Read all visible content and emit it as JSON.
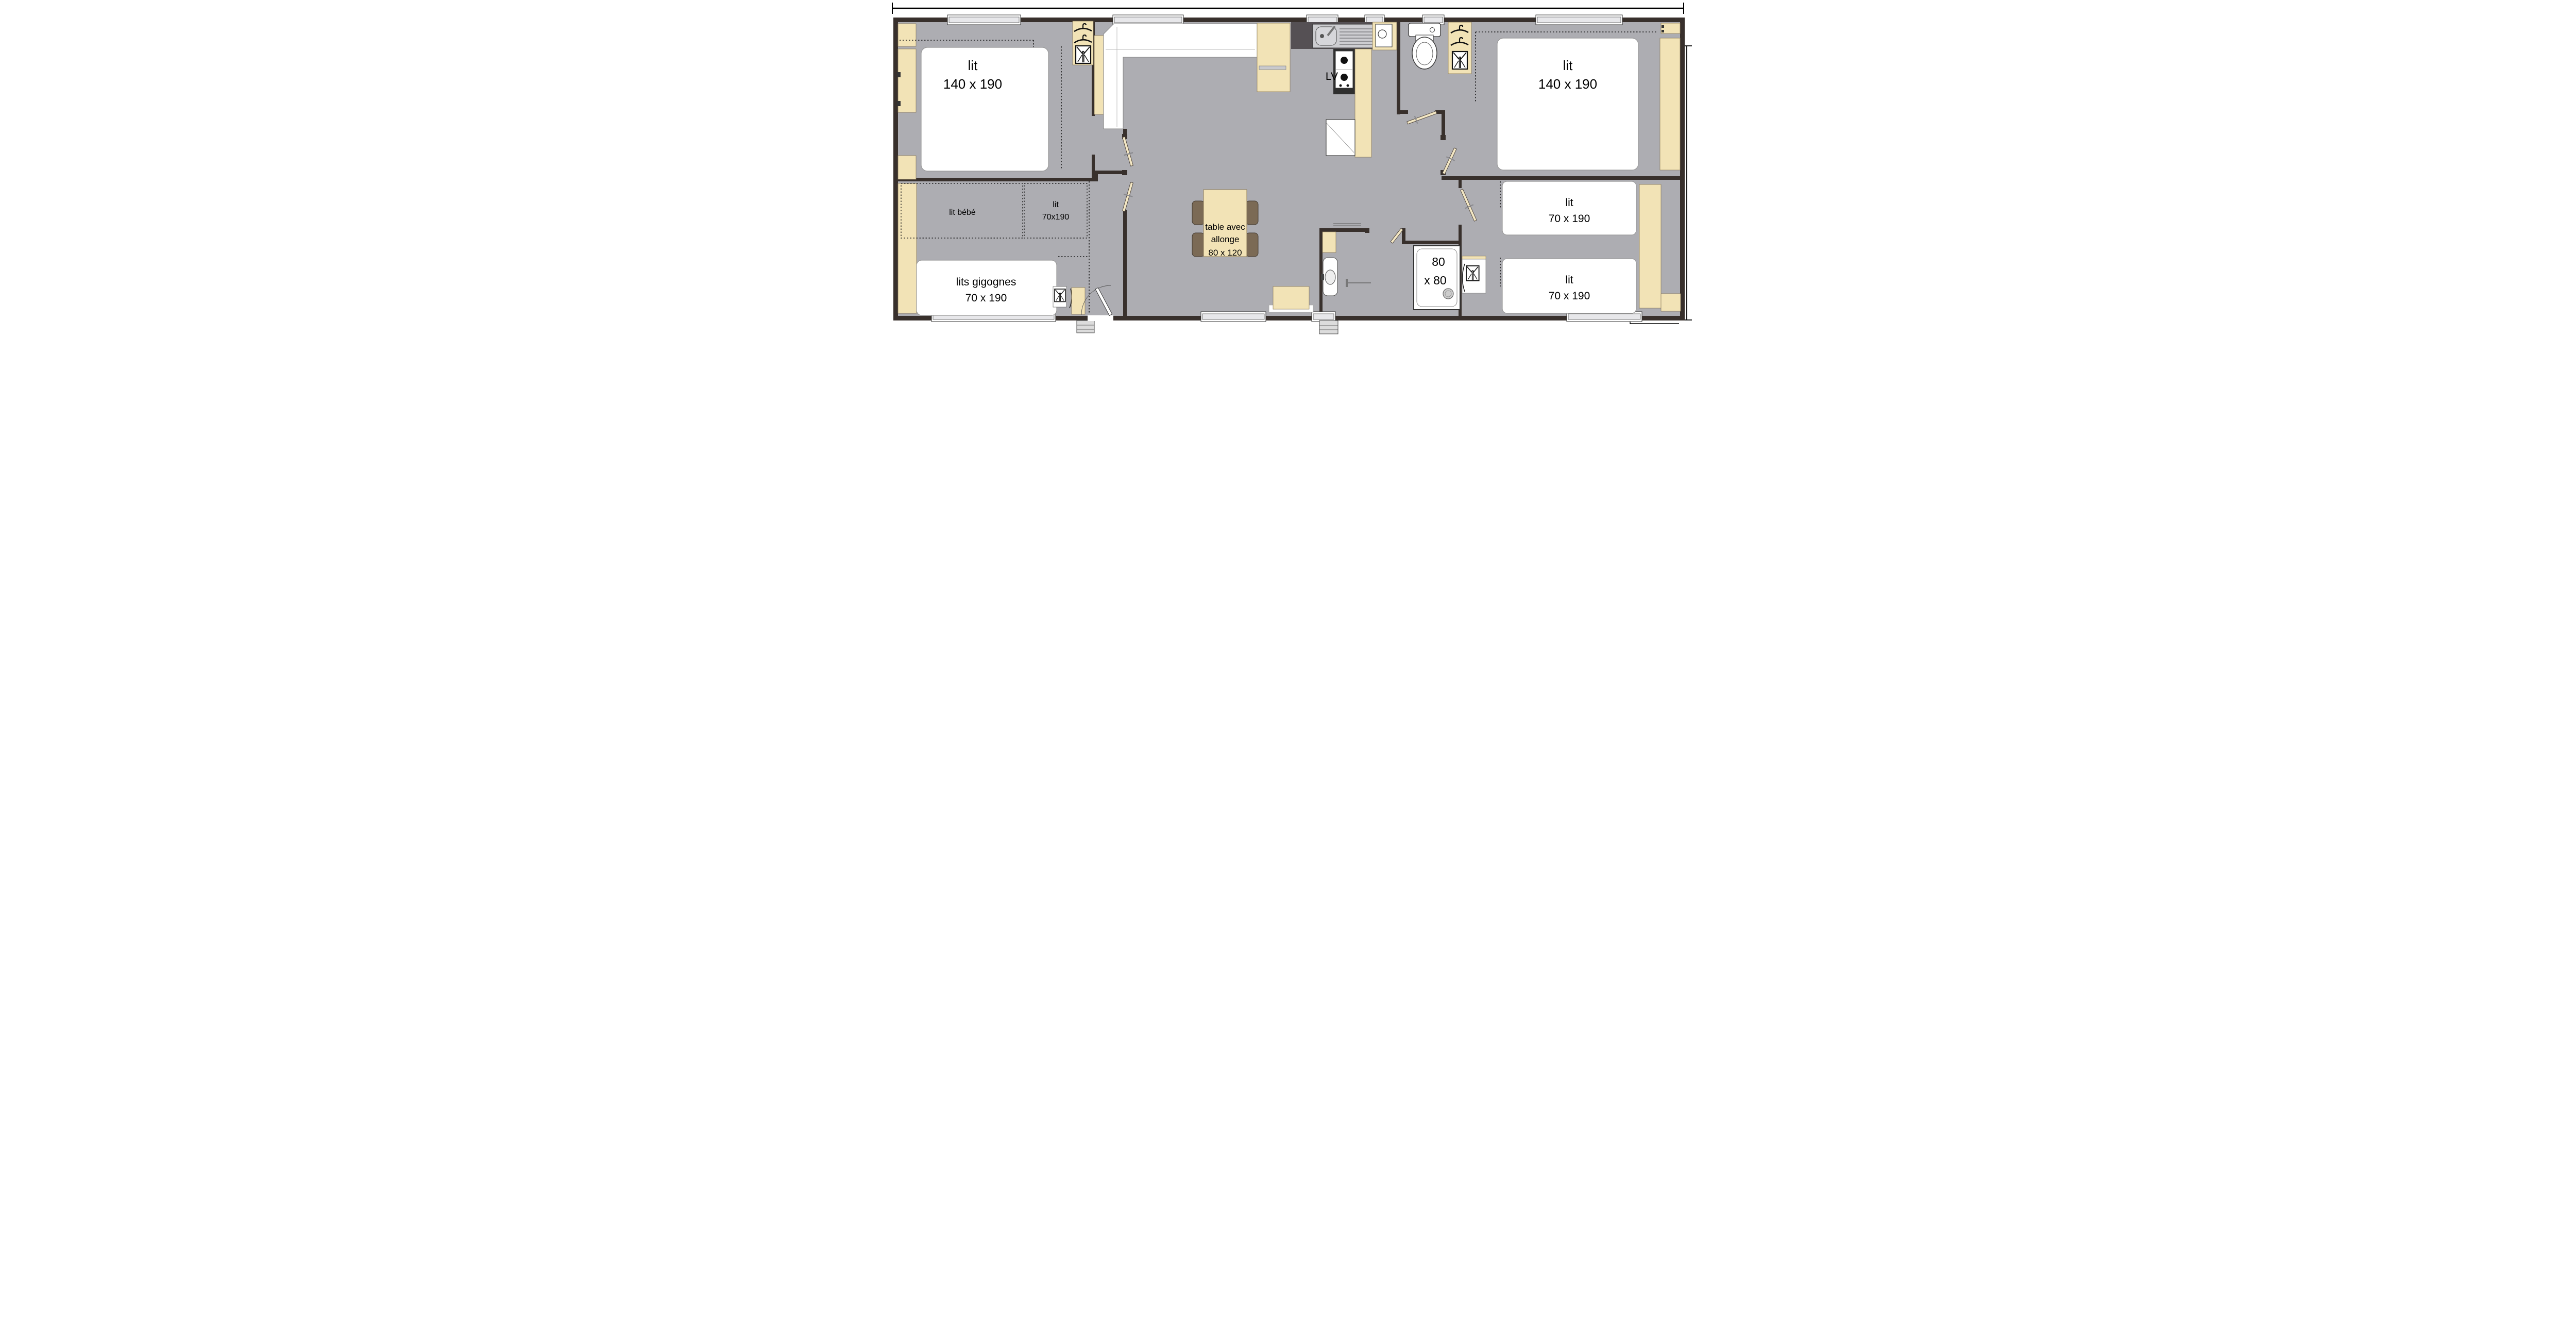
{
  "plan": {
    "type": "floor-plan",
    "labels": {
      "master_bed_1": "lit",
      "master_bed_2": "140 x 190",
      "baby_bed": "lit bébé",
      "small_single_1": "lit",
      "small_single_2": "70x190",
      "nesting_beds_1": "lits gigognes",
      "nesting_beds_2": "70 x 190",
      "table_1": "table avec",
      "table_2": "allonge",
      "table_3": "80 x 120",
      "dishwasher": "LV",
      "shower_1": "80",
      "shower_2": "x 80",
      "right_bed_1": "lit",
      "right_bed_2": "140 x 190",
      "kids_bed_top_1": "lit",
      "kids_bed_top_2": "70 x 190",
      "kids_bed_bottom_1": "lit",
      "kids_bed_bottom_2": "70 x 190"
    },
    "colors": {
      "floor": "#adadb2",
      "wall": "#38302c",
      "furniture": "#f2e3b6",
      "door_leaf": "#f3e7c4",
      "counter": "#555054",
      "chair": "#7b6a55",
      "window_glass": "#e7e7ea",
      "step": "#dcdcdc",
      "white_fixture": "#ffffff"
    },
    "icons": [
      "hanger-icon",
      "shirt-icon",
      "toilet-icon",
      "sink-icon",
      "faucet-icon",
      "burner-icon",
      "shower-drain-icon",
      "washbasin-icon",
      "door-leaf-icon"
    ]
  }
}
